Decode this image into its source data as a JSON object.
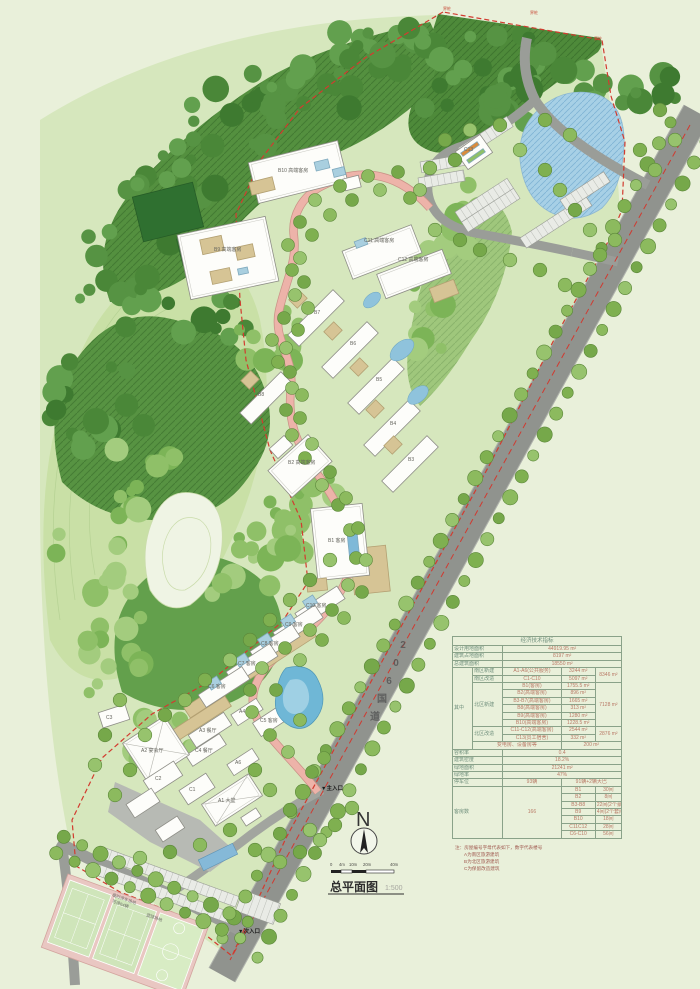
{
  "title": {
    "text": "总平面图",
    "scale": "1:500"
  },
  "compass": {
    "north": "N"
  },
  "scale_bar": {
    "ticks": [
      "0",
      "4m",
      "10m",
      "20m",
      "40m"
    ]
  },
  "road": {
    "name": "206国道",
    "chars": [
      "2",
      "0",
      "6",
      "国",
      "道"
    ]
  },
  "entrances": {
    "main": "▼主入口",
    "secondary": "▼次入口"
  },
  "boundary": {
    "markers": [
      "界桩",
      "界桩",
      "界桩"
    ]
  },
  "site_labels": {
    "a1": "A1 大堂",
    "a2": "A2 宴会厅",
    "a3": "A3 餐厅",
    "a4": "A4",
    "a6": "A6",
    "c1": "C1",
    "c2": "C2",
    "c3": "C3",
    "c4": "C4 餐厅",
    "c5": "C5 客房",
    "c6": "C6 客房",
    "c7": "C7 客房",
    "c8": "C8 客房",
    "c9": "C9 客房",
    "c10": "C10 客房",
    "b1": "B1 客房",
    "b2": "B2 高端客房",
    "b3": "B3",
    "b4": "B4",
    "b5": "B5",
    "b6": "B6",
    "b7": "B7",
    "b8": "B8",
    "b9": "B9 高端客房",
    "b10": "B10 高端客房",
    "c11": "C11 高端客房",
    "c12": "C12 高端客房",
    "c13": "C13",
    "courts_parking_1": "临时停车场地",
    "courts_parking_2": "可停64辆",
    "court": "篮球场地"
  },
  "notes": {
    "heading": "注：房屋编号字母代表如下，数字代表楼号",
    "a": "A为南区旅游建筑",
    "b": "B为北区旅游建筑",
    "c": "C为保留改造建筑"
  },
  "table": {
    "title": "经济技术指标",
    "rows": [
      [
        {
          "t": "设计用地面积",
          "cs": 2,
          "c": "lab"
        },
        {
          "t": "44919.95 m²",
          "cs": 3
        }
      ],
      [
        {
          "t": "建筑占地面积",
          "cs": 2,
          "c": "lab"
        },
        {
          "t": "8197 m²",
          "cs": 3
        }
      ],
      [
        {
          "t": "总建筑面积",
          "cs": 2,
          "c": "lab"
        },
        {
          "t": "18550 m²",
          "cs": 3
        }
      ],
      [
        {
          "t": "其中",
          "rs": 11,
          "c": "lab"
        },
        {
          "t": "南区新建",
          "c": "lab"
        },
        {
          "t": "A1-A6(公共服务)"
        },
        {
          "t": "3244 m²"
        },
        {
          "t": "8346 m²",
          "rs": 2
        }
      ],
      [
        {
          "t": "南区改造",
          "c": "lab"
        },
        {
          "t": "C1-C10"
        },
        {
          "t": "5097 m²"
        }
      ],
      [
        {
          "t": "北区新建",
          "rs": 6,
          "c": "lab"
        },
        {
          "t": "B1(客房)"
        },
        {
          "t": "1755.5 m²"
        },
        {
          "t": "7128 m²",
          "rs": 6
        }
      ],
      [
        {
          "t": "B2(高端客房)"
        },
        {
          "t": "896 m²"
        }
      ],
      [
        {
          "t": "B3-B7(高端客房)"
        },
        {
          "t": "1665 m²"
        }
      ],
      [
        {
          "t": "B8(高端客房)"
        },
        {
          "t": "313 m²"
        }
      ],
      [
        {
          "t": "B9(高端客房)"
        },
        {
          "t": "1280 m²"
        }
      ],
      [
        {
          "t": "B10(高端客房)"
        },
        {
          "t": "1228.5 m²"
        }
      ],
      [
        {
          "t": "北区改造",
          "rs": 2,
          "c": "lab"
        },
        {
          "t": "C11-C12(高端客房)"
        },
        {
          "t": "2544 m²"
        },
        {
          "t": "2876 m²",
          "rs": 2
        }
      ],
      [
        {
          "t": "C13(员工宿舍)"
        },
        {
          "t": "332 m²"
        }
      ],
      [
        {
          "t": "变电房、设备房等",
          "cs": 2
        },
        {
          "t": "200 m²",
          "cs": 2
        }
      ],
      [
        {
          "t": "容积率",
          "cs": 2,
          "c": "lab"
        },
        {
          "t": "0.4",
          "cs": 3
        }
      ],
      [
        {
          "t": "建筑密度",
          "cs": 2,
          "c": "lab"
        },
        {
          "t": "18.2%",
          "cs": 3
        }
      ],
      [
        {
          "t": "绿地面积",
          "cs": 2,
          "c": "lab"
        },
        {
          "t": "21241 m²",
          "cs": 3
        }
      ],
      [
        {
          "t": "绿地率",
          "cs": 2,
          "c": "lab"
        },
        {
          "t": "47%",
          "cs": 3
        }
      ],
      [
        {
          "t": "停车位",
          "cs": 2,
          "c": "lab"
        },
        {
          "t": "93辆"
        },
        {
          "t": "91辆+2辆大巴",
          "cs": 2
        }
      ],
      [
        {
          "t": "客房数",
          "cs": 2,
          "rs": 7,
          "c": "lab"
        },
        {
          "t": "166",
          "rs": 7
        },
        {
          "t": "B1"
        },
        {
          "t": "30间"
        }
      ],
      [
        {
          "t": "B2"
        },
        {
          "t": "8间"
        }
      ],
      [
        {
          "t": "B3-B8"
        },
        {
          "t": "22间(2个豪华套间)"
        }
      ],
      [
        {
          "t": "B9"
        },
        {
          "t": "4间(2个套间)"
        }
      ],
      [
        {
          "t": "B10"
        },
        {
          "t": "18间"
        }
      ],
      [
        {
          "t": "C11C12"
        },
        {
          "t": "28间"
        }
      ],
      [
        {
          "t": "C6-C10"
        },
        {
          "t": "56间"
        }
      ]
    ]
  }
}
